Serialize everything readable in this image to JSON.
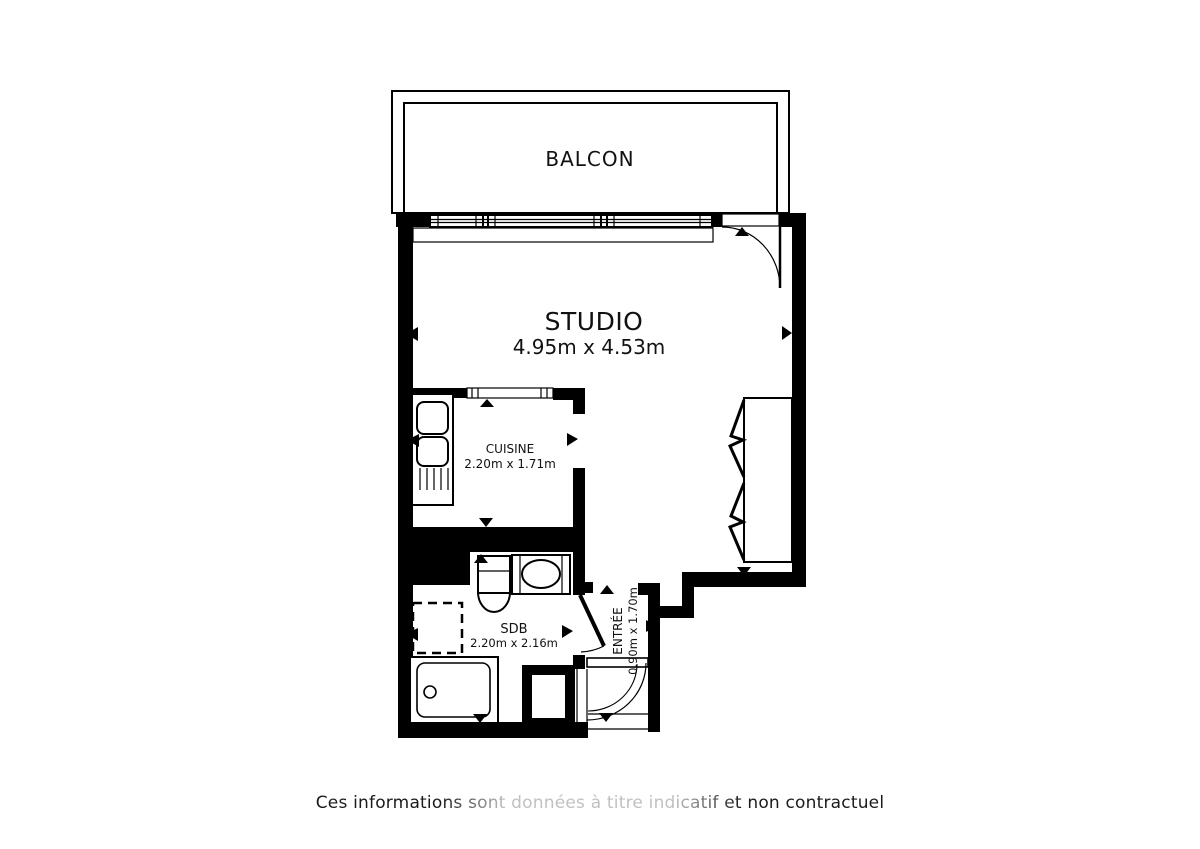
{
  "plan": {
    "balcony": {
      "label": "BALCON"
    },
    "studio": {
      "label": "STUDIO",
      "dimensions": "4.95m x 4.53m"
    },
    "kitchen": {
      "label": "CUISINE",
      "dimensions": "2.20m x 1.71m"
    },
    "bathroom": {
      "label": "SDB",
      "dimensions": "2.20m x 2.16m"
    },
    "entrance": {
      "label": "ENTRÉE",
      "dimensions": "0.90m x 1.70m"
    }
  },
  "footer": {
    "disclaimer": "Ces informations sont données à titre indicatif et non contractuel"
  },
  "colors": {
    "wall": "#000000",
    "background": "#ffffff",
    "text": "#1a1a1a"
  }
}
